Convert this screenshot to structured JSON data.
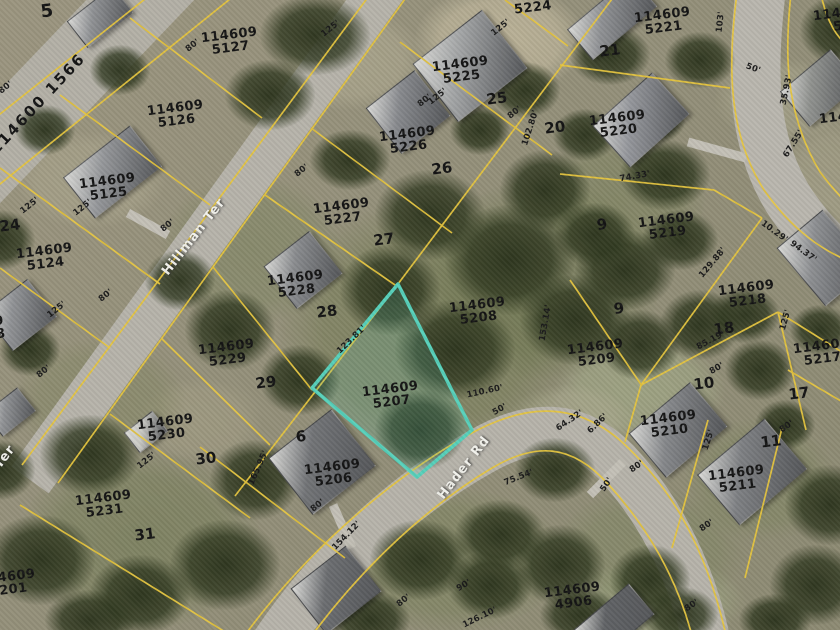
{
  "map": {
    "title": "aerial parcel map",
    "highlighted_parcel": {
      "id": "114609 5207",
      "outline_color": "#56d0ba"
    },
    "colors": {
      "parcel_line": "#e6c53e",
      "highlight": "#56d0ba",
      "label_text": "#141414",
      "street_text": "#f2f2ec",
      "road": "#b6b3aa"
    },
    "streets": [
      {
        "label": "Hillman Ter",
        "x": 194,
        "y": 237,
        "r": -52
      },
      {
        "label": "Hader Rd",
        "x": 464,
        "y": 468,
        "r": -52
      },
      {
        "label": "Ter",
        "x": 5,
        "y": 457,
        "r": -52
      }
    ],
    "road_parcel": {
      "label": "114600 1566",
      "x": 38,
      "y": 104,
      "r": -47
    },
    "parcels": [
      {
        "lines": [
          "5224"
        ],
        "x": 533,
        "y": 8
      },
      {
        "lines": [
          "114609",
          "5225"
        ],
        "x": 461,
        "y": 71
      },
      {
        "lines": [
          "114609",
          "5226"
        ],
        "x": 408,
        "y": 141
      },
      {
        "lines": [
          "114609",
          "5227"
        ],
        "x": 342,
        "y": 213
      },
      {
        "lines": [
          "114609",
          "5228"
        ],
        "x": 296,
        "y": 285
      },
      {
        "lines": [
          "114609",
          "5127"
        ],
        "x": 230,
        "y": 42
      },
      {
        "lines": [
          "114609",
          "5126"
        ],
        "x": 176,
        "y": 115
      },
      {
        "lines": [
          "114609",
          "5125"
        ],
        "x": 108,
        "y": 188
      },
      {
        "lines": [
          "114609",
          "5124"
        ],
        "x": 45,
        "y": 258
      },
      {
        "lines": [
          "114609",
          "5229"
        ],
        "x": 227,
        "y": 354
      },
      {
        "lines": [
          "114609",
          "5230"
        ],
        "x": 166,
        "y": 429
      },
      {
        "lines": [
          "114609",
          "5231"
        ],
        "x": 104,
        "y": 505
      },
      {
        "lines": [
          "114609",
          "5201"
        ],
        "x": 8,
        "y": 584
      },
      {
        "lines": [
          "114609",
          "5206"
        ],
        "x": 333,
        "y": 474
      },
      {
        "lines": [
          "114609",
          "5207"
        ],
        "x": 391,
        "y": 396,
        "hl": true
      },
      {
        "lines": [
          "114609",
          "5208"
        ],
        "x": 478,
        "y": 312
      },
      {
        "lines": [
          "114609",
          "5209"
        ],
        "x": 596,
        "y": 354
      },
      {
        "lines": [
          "114609",
          "5219"
        ],
        "x": 667,
        "y": 227
      },
      {
        "lines": [
          "114609",
          "5218"
        ],
        "x": 747,
        "y": 295
      },
      {
        "lines": [
          "114609",
          "5217"
        ],
        "x": 822,
        "y": 353
      },
      {
        "lines": [
          "114609",
          "5210"
        ],
        "x": 669,
        "y": 425
      },
      {
        "lines": [
          "114609",
          "5211"
        ],
        "x": 737,
        "y": 480
      },
      {
        "lines": [
          "114609",
          "4906"
        ],
        "x": 573,
        "y": 597
      },
      {
        "lines": [
          "114609",
          "5220"
        ],
        "x": 618,
        "y": 125
      },
      {
        "lines": [
          "114609",
          "5221"
        ],
        "x": 663,
        "y": 22
      },
      {
        "lines": [
          "114609",
          "52"
        ],
        "x": 842,
        "y": 20
      },
      {
        "lines": [
          "114609",
          "5"
        ],
        "x": 848,
        "y": 123
      },
      {
        "lines": [
          "9",
          "8"
        ],
        "x": 0,
        "y": 328
      }
    ],
    "lot_numbers": [
      {
        "t": "5",
        "x": 47,
        "y": 12,
        "s": 18
      },
      {
        "t": "25",
        "x": 497,
        "y": 99
      },
      {
        "t": "20",
        "x": 555,
        "y": 128
      },
      {
        "t": "21",
        "x": 610,
        "y": 51
      },
      {
        "t": "26",
        "x": 442,
        "y": 169
      },
      {
        "t": "27",
        "x": 384,
        "y": 240
      },
      {
        "t": "28",
        "x": 327,
        "y": 312
      },
      {
        "t": "29",
        "x": 266,
        "y": 383
      },
      {
        "t": "30",
        "x": 206,
        "y": 459
      },
      {
        "t": "31",
        "x": 145,
        "y": 535
      },
      {
        "t": "24",
        "x": 10,
        "y": 226
      },
      {
        "t": "6",
        "x": 301,
        "y": 437
      },
      {
        "t": "9",
        "x": 619,
        "y": 309
      },
      {
        "t": "9",
        "x": 602,
        "y": 225
      },
      {
        "t": "10",
        "x": 704,
        "y": 384
      },
      {
        "t": "11",
        "x": 771,
        "y": 442
      },
      {
        "t": "17",
        "x": 799,
        "y": 394
      },
      {
        "t": "18",
        "x": 724,
        "y": 329
      }
    ],
    "dimensions": [
      {
        "t": "80'",
        "x": 193,
        "y": 46,
        "r": -38
      },
      {
        "t": "80'",
        "x": 6,
        "y": 88,
        "r": -38
      },
      {
        "t": "125'",
        "x": 30,
        "y": 206,
        "r": -38
      },
      {
        "t": "125'",
        "x": 83,
        "y": 208,
        "r": -38
      },
      {
        "t": "125'",
        "x": 331,
        "y": 29,
        "r": -38
      },
      {
        "t": "125'",
        "x": 501,
        "y": 28,
        "r": -38
      },
      {
        "t": "80'",
        "x": 425,
        "y": 101,
        "r": -38
      },
      {
        "t": "80'",
        "x": 515,
        "y": 113,
        "r": -38
      },
      {
        "t": "102.80'",
        "x": 531,
        "y": 128,
        "r": -72
      },
      {
        "t": "125'",
        "x": 438,
        "y": 97,
        "r": -38
      },
      {
        "t": "80'",
        "x": 302,
        "y": 171,
        "r": -38
      },
      {
        "t": "50'",
        "x": 753,
        "y": 69,
        "r": 20
      },
      {
        "t": "103'",
        "x": 721,
        "y": 22,
        "r": -84
      },
      {
        "t": "35.93'",
        "x": 787,
        "y": 90,
        "r": -78
      },
      {
        "t": "67.55'",
        "x": 794,
        "y": 144,
        "r": -58
      },
      {
        "t": "10.29'",
        "x": 774,
        "y": 232,
        "r": 36
      },
      {
        "t": "94.37'",
        "x": 803,
        "y": 252,
        "r": 36
      },
      {
        "t": "74.33'",
        "x": 635,
        "y": 177,
        "r": -10
      },
      {
        "t": "129.88'",
        "x": 713,
        "y": 263,
        "r": -50
      },
      {
        "t": "85.19'",
        "x": 711,
        "y": 341,
        "r": -28
      },
      {
        "t": "125'",
        "x": 786,
        "y": 320,
        "r": -74
      },
      {
        "t": "80'",
        "x": 717,
        "y": 369,
        "r": -30
      },
      {
        "t": "123.81'",
        "x": 352,
        "y": 340,
        "r": -44
      },
      {
        "t": "153.14'",
        "x": 546,
        "y": 323,
        "r": -80
      },
      {
        "t": "110.60'",
        "x": 485,
        "y": 392,
        "r": -12
      },
      {
        "t": "80'",
        "x": 168,
        "y": 226,
        "r": -38
      },
      {
        "t": "80'",
        "x": 106,
        "y": 296,
        "r": -38
      },
      {
        "t": "125'",
        "x": 57,
        "y": 310,
        "r": -38
      },
      {
        "t": "80'",
        "x": 44,
        "y": 372,
        "r": -38
      },
      {
        "t": "125'",
        "x": 147,
        "y": 461,
        "r": -38
      },
      {
        "t": "165.95'",
        "x": 259,
        "y": 468,
        "r": -66
      },
      {
        "t": "80'",
        "x": 318,
        "y": 506,
        "r": -38
      },
      {
        "t": "154.12'",
        "x": 347,
        "y": 536,
        "r": -46
      },
      {
        "t": "80'",
        "x": 404,
        "y": 601,
        "r": -38
      },
      {
        "t": "90'",
        "x": 464,
        "y": 586,
        "r": -30
      },
      {
        "t": "126.10'",
        "x": 480,
        "y": 618,
        "r": -26
      },
      {
        "t": "75.54'",
        "x": 519,
        "y": 478,
        "r": -22
      },
      {
        "t": "50'",
        "x": 500,
        "y": 410,
        "r": -30
      },
      {
        "t": "64.32'",
        "x": 570,
        "y": 421,
        "r": -34
      },
      {
        "t": "6.86'",
        "x": 598,
        "y": 424,
        "r": -44
      },
      {
        "t": "50'",
        "x": 607,
        "y": 485,
        "r": -56
      },
      {
        "t": "80'",
        "x": 637,
        "y": 467,
        "r": -34
      },
      {
        "t": "125'",
        "x": 709,
        "y": 440,
        "r": -72
      },
      {
        "t": "80'",
        "x": 787,
        "y": 427,
        "r": -34
      },
      {
        "t": "80'",
        "x": 707,
        "y": 526,
        "r": -34
      },
      {
        "t": "80'",
        "x": 692,
        "y": 606,
        "r": -34
      }
    ]
  }
}
